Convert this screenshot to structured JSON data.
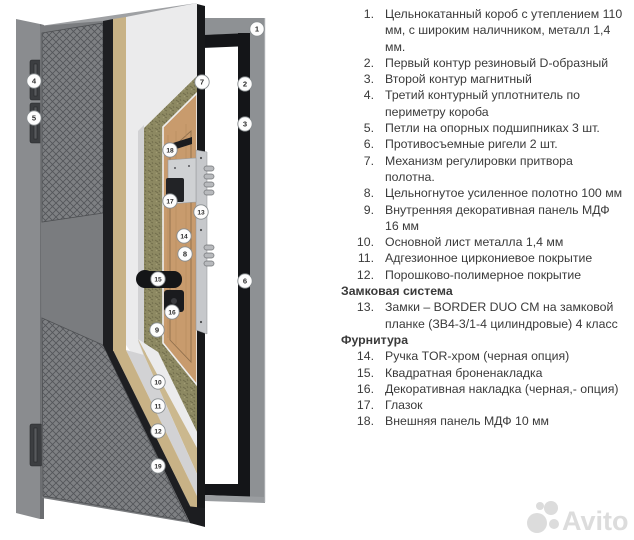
{
  "diagram": {
    "description": "Cutaway diagram of insulated steel entrance door with frame, hinges, lock hardware and layered leaf construction",
    "callouts": [
      {
        "n": "1",
        "x": 257,
        "y": 29
      },
      {
        "n": "2",
        "x": 245,
        "y": 84
      },
      {
        "n": "3",
        "x": 245,
        "y": 124
      },
      {
        "n": "4",
        "x": 34,
        "y": 81
      },
      {
        "n": "5",
        "x": 34,
        "y": 118
      },
      {
        "n": "6",
        "x": 245,
        "y": 281
      },
      {
        "n": "7",
        "x": 202,
        "y": 82
      },
      {
        "n": "8",
        "x": 185,
        "y": 254
      },
      {
        "n": "9",
        "x": 157,
        "y": 330
      },
      {
        "n": "10",
        "x": 158,
        "y": 382
      },
      {
        "n": "11",
        "x": 158,
        "y": 406
      },
      {
        "n": "12",
        "x": 158,
        "y": 431
      },
      {
        "n": "13",
        "x": 201,
        "y": 212
      },
      {
        "n": "14",
        "x": 184,
        "y": 236
      },
      {
        "n": "15",
        "x": 158,
        "y": 279
      },
      {
        "n": "16",
        "x": 172,
        "y": 312
      },
      {
        "n": "17",
        "x": 170,
        "y": 201
      },
      {
        "n": "18",
        "x": 170,
        "y": 150
      },
      {
        "n": "19",
        "x": 158,
        "y": 466
      }
    ],
    "colors": {
      "leftPost": "#8a8c8f",
      "postShadow": "#6c6e71",
      "outerPanel": "#7a7c7f",
      "blackLayer": "#1e1f22",
      "gold": "#c8b286",
      "goldLight": "#cbb88e",
      "whiteLayer": "#ebebec",
      "lightGray": "#d2d2d4",
      "wool": "#8d8962",
      "wood": "#c89b6d",
      "edge": "#17181a",
      "chrome": "#c6c8cb",
      "frameGray": "#8e9194",
      "frameDark": "#141518",
      "topSliver": "#9fa1a4",
      "circleStroke": "#878c8f",
      "text": "#3a3a3a",
      "watermark": "#dcdcdc"
    }
  },
  "parts_list": {
    "items": [
      {
        "num": "1.",
        "lines": [
          "Цельнокатанный короб с утеплением 110",
          "мм, с широким наличником, металл 1,4",
          "мм."
        ]
      },
      {
        "num": "2.",
        "lines": [
          "Первый контур резиновый D-образный"
        ]
      },
      {
        "num": "3.",
        "lines": [
          "Второй контур магнитный"
        ]
      },
      {
        "num": "4.",
        "lines": [
          "Третий контурный уплотнитель по",
          "периметру короба"
        ]
      },
      {
        "num": "5.",
        "lines": [
          "Петли на опорных подшипниках 3 шт."
        ]
      },
      {
        "num": "6.",
        "lines": [
          "Противосъемные ригели 2 шт."
        ]
      },
      {
        "num": "7.",
        "lines": [
          "Механизм регулировки притвора",
          "полотна."
        ]
      },
      {
        "num": "8.",
        "lines": [
          "Цельногнутое усиленное полотно 100 мм"
        ]
      },
      {
        "num": "9.",
        "lines": [
          "Внутренняя декоративная панель МДФ",
          "16 мм"
        ]
      },
      {
        "num": "10.",
        "lines": [
          "Основной лист металла 1,4 мм"
        ]
      },
      {
        "num": "11.",
        "lines": [
          "Адгезионное циркониевое покрытие"
        ]
      },
      {
        "num": "12.",
        "lines": [
          "Порошково-полимерное покрытие"
        ]
      },
      {
        "header": true,
        "text": "Замковая система"
      },
      {
        "num": "13.",
        "lines": [
          "Замки – BORDER DUO CM на замковой",
          "планке (ЗВ4-3/1-4 цилиндровые) 4 класс"
        ]
      },
      {
        "header": true,
        "text": "Фурнитура"
      },
      {
        "num": "14.",
        "lines": [
          "Ручка TOR-хром (черная опция)"
        ]
      },
      {
        "num": "15.",
        "lines": [
          "Квадратная броненакладка"
        ]
      },
      {
        "num": "16.",
        "lines": [
          "Декоративная накладка (черная,- опция)"
        ]
      },
      {
        "num": "17.",
        "lines": [
          "Глазок"
        ]
      },
      {
        "num": "18.",
        "lines": [
          "Внешняя панель МДФ 10 мм"
        ]
      }
    ]
  },
  "watermark": {
    "text": "Avito"
  }
}
